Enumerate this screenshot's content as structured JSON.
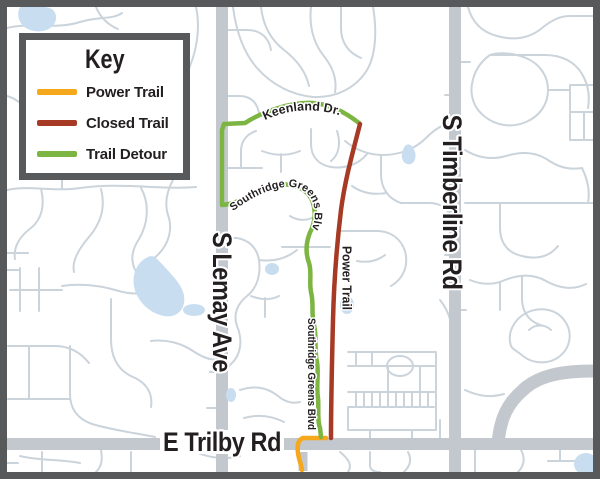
{
  "map": {
    "key": {
      "title": "Key",
      "items": [
        {
          "label": "Power Trail",
          "color": "#F6A81C"
        },
        {
          "label": "Closed Trail",
          "color": "#A63A24"
        },
        {
          "label": "Trail Detour",
          "color": "#7CB542"
        }
      ]
    },
    "labels": {
      "lemay": "S Lemay Ave",
      "timberline": "S Timberline Rd",
      "trilby": "E Trilby Rd",
      "keenland": "Keenland Dr.",
      "southridge_upper": "Southridge Greens Blvd",
      "southridge_lower": "Southridge Greens Blvd",
      "power_trail": "Power Trail"
    },
    "colors": {
      "power_trail": "#F6A81C",
      "closed_trail": "#A63A24",
      "trail_detour": "#7CB542",
      "major_road": "#C3C8CE",
      "minor_road": "#CBD3DB",
      "water": "#C9DDF0",
      "border": "#58595B",
      "label_text": "#231F20",
      "background": "#FFFFFF"
    }
  }
}
